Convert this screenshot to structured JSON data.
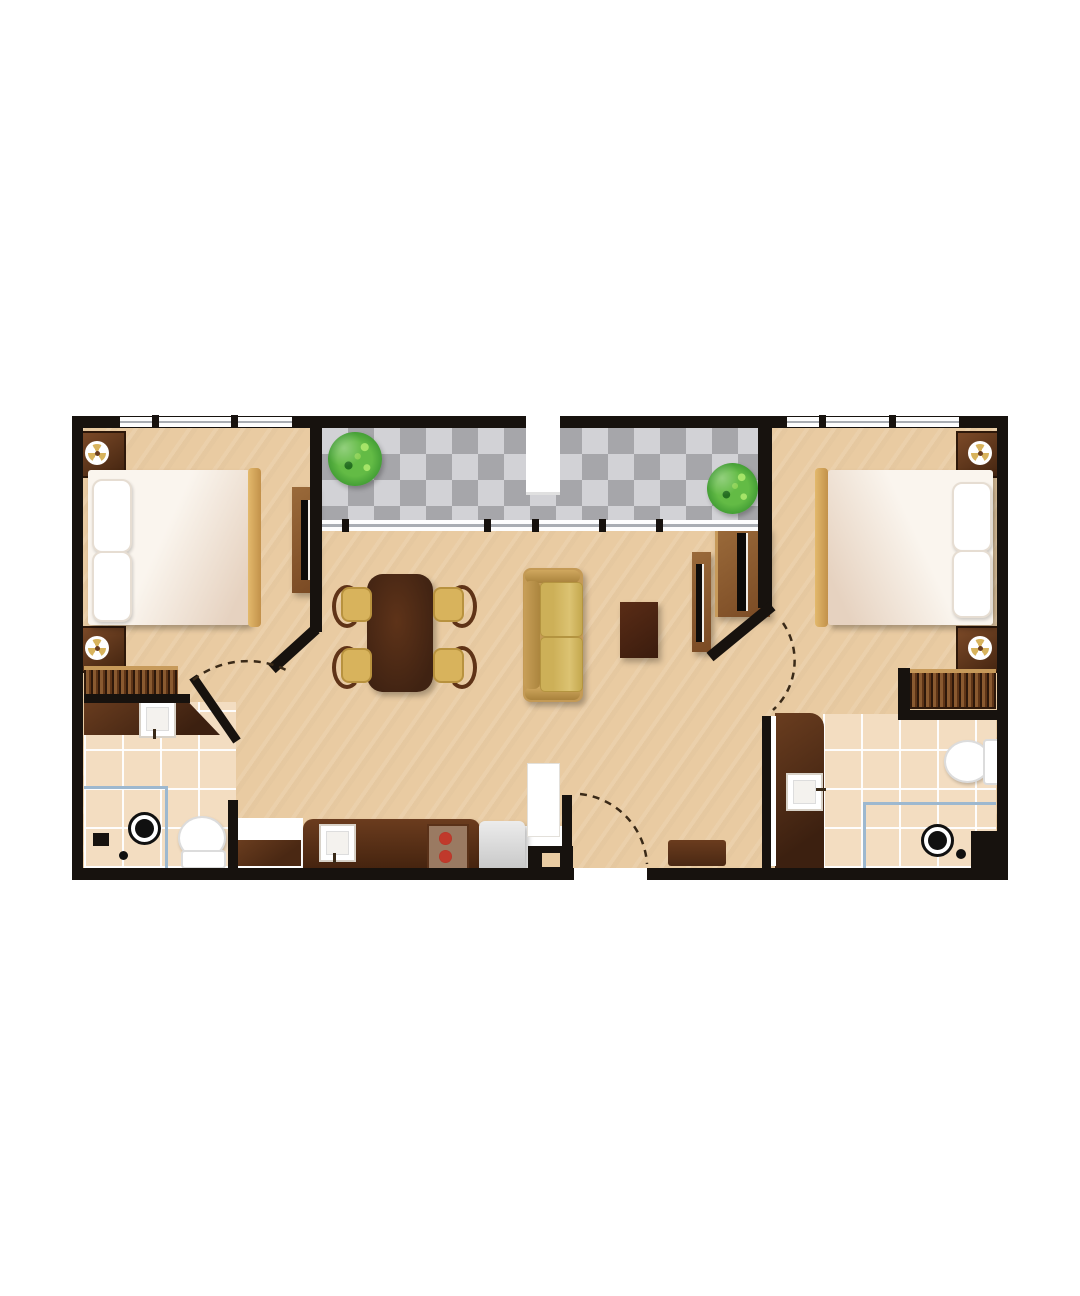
{
  "plan": {
    "kind": "apartment-floor-plan-illustration",
    "orientation": "top-down 2D, no text labels rendered",
    "rooms": [
      {
        "name": "balcony",
        "position": "top-center",
        "floor": "gray checkerboard tile",
        "items": [
          "green-bush-plant-left",
          "green-bush-plant-right",
          "window-wall-to-living-room",
          "white-wall-notch"
        ]
      },
      {
        "name": "bedroom-1",
        "position": "left",
        "items": [
          "double-bed-with-two-pillows",
          "footboard-rail",
          "nightstand-with-ceiling-lamp-top",
          "nightstand-with-ceiling-lamp-bottom",
          "tv-dresser-with-black-screen",
          "closet-hanging-clothes",
          "window-top-wall",
          "door-with-dashed-swing-arc"
        ]
      },
      {
        "name": "bathroom-1",
        "position": "bottom-left",
        "items": [
          "angled-vanity-counter-with-square-sink",
          "toilet",
          "shower-drain",
          "floor-drain-dot",
          "tiled-floor-with-blue-accent-lines"
        ]
      },
      {
        "name": "living-dining-room",
        "position": "center",
        "items": [
          "dark-wood-dining-table",
          "dining-chair x4",
          "two-seat-sofa",
          "dark-side-table",
          "tv-console-living",
          "tv-console-bedroom2"
        ]
      },
      {
        "name": "kitchen",
        "position": "bottom-center",
        "items": [
          "counter-with-square-sink",
          "stove-two-red-burners",
          "refrigerator-light-gray",
          "low-cabinet"
        ]
      },
      {
        "name": "entry",
        "position": "bottom-center",
        "items": [
          "entry-opening-in-bottom-wall",
          "dashed-door-swing-arc",
          "white-utility-door",
          "wall-stub-with-square-notch",
          "brown-door-mat"
        ]
      },
      {
        "name": "bedroom-2",
        "position": "right",
        "items": [
          "double-bed-with-two-pillows",
          "footboard-rail",
          "nightstand-with-ceiling-lamp-top",
          "nightstand-with-ceiling-lamp-bottom",
          "closet-hanging-clothes",
          "window-top-wall",
          "door-with-dashed-swing-arc"
        ]
      },
      {
        "name": "bathroom-2",
        "position": "bottom-right",
        "items": [
          "vanity-counter-with-square-sink",
          "toilet-with-tank",
          "shower-drain",
          "floor-drain-dot",
          "tiled-floor-with-blue-accent-lines"
        ]
      }
    ],
    "door_swing_arcs": 3,
    "windows": [
      "bedroom-1-top",
      "bedroom-2-top",
      "balcony-sill-to-living-room"
    ]
  },
  "colors": {
    "wall": "#17120e",
    "floor": "#e9cba2",
    "balconyDark": "#a6a6aa",
    "balconyLight": "#d2d2d6",
    "tile": "#f3ddc1",
    "blue": "#9db8cf",
    "tanLight": "#d8b35c",
    "tv": "#0d0b09",
    "burnerRed": "#c0392b",
    "plantGreen": "#3f9a33",
    "linen": "#faf5ee",
    "woodDark": "#4a2813",
    "woodLight": "#c79a5a"
  }
}
